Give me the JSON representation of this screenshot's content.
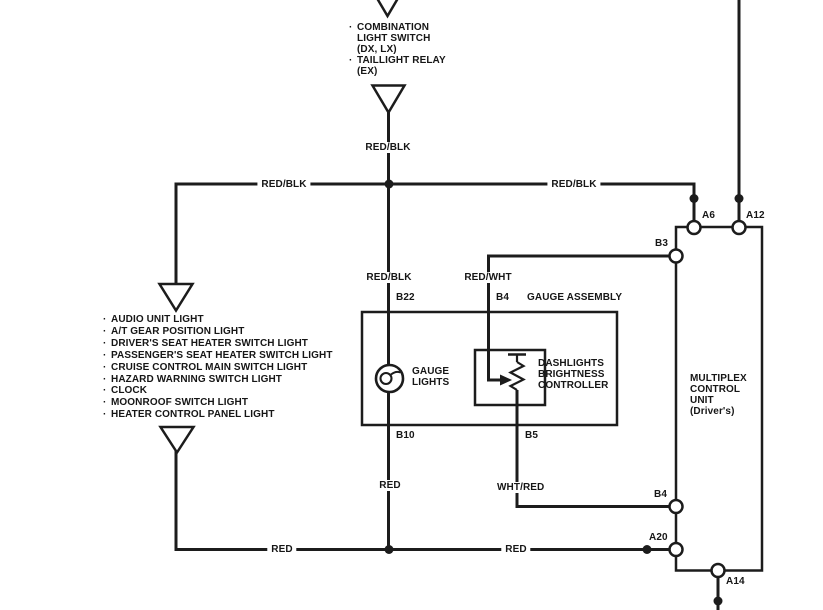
{
  "diagram": {
    "title_context": "dash lights circuit",
    "colors": {
      "line": "#1c1c1c",
      "background": "#ffffff"
    },
    "top_component_list": {
      "lines": [
        {
          "bullet": "·",
          "text": "COMBINATION"
        },
        {
          "bullet": "",
          "text": "LIGHT SWITCH"
        },
        {
          "bullet": "",
          "text": "(DX, LX)"
        },
        {
          "bullet": "·",
          "text": "TAILLIGHT RELAY"
        },
        {
          "bullet": "",
          "text": "(EX)"
        }
      ]
    },
    "left_component_list": {
      "lines": [
        {
          "bullet": "·",
          "text": "AUDIO UNIT LIGHT"
        },
        {
          "bullet": "·",
          "text": "A/T GEAR POSITION LIGHT"
        },
        {
          "bullet": "·",
          "text": "DRIVER'S SEAT HEATER SWITCH LIGHT"
        },
        {
          "bullet": "·",
          "text": "PASSENGER'S SEAT HEATER SWITCH LIGHT"
        },
        {
          "bullet": "·",
          "text": "CRUISE CONTROL MAIN SWITCH LIGHT"
        },
        {
          "bullet": "·",
          "text": "HAZARD WARNING SWITCH LIGHT"
        },
        {
          "bullet": "·",
          "text": "CLOCK"
        },
        {
          "bullet": "·",
          "text": "MOONROOF SWITCH LIGHT"
        },
        {
          "bullet": "·",
          "text": "HEATER CONTROL PANEL LIGHT"
        }
      ]
    },
    "wire_labels": {
      "red_blk_top": "RED/BLK",
      "red_blk_left": "RED/BLK",
      "red_blk_right": "RED/BLK",
      "red_blk_gauge": "RED/BLK",
      "red_wht": "RED/WHT",
      "red_gauge": "RED",
      "wht_red": "WHT/RED",
      "red_bottom_left": "RED",
      "red_bottom_right": "RED"
    },
    "terminals": {
      "b22": "B22",
      "b4_gauge": "B4",
      "b10": "B10",
      "b5": "B5",
      "b3": "B3",
      "a6": "A6",
      "a12": "A12",
      "b4_mux": "B4",
      "a20": "A20",
      "a14": "A14"
    },
    "components": {
      "gauge_assembly_title": "GAUGE ASSEMBLY",
      "gauge_lights": {
        "lines": [
          "GAUGE",
          "LIGHTS"
        ]
      },
      "dashlights_controller": {
        "lines": [
          "DASHLIGHTS",
          "BRIGHTNESS",
          "CONTROLLER"
        ]
      },
      "multiplex_unit": {
        "lines": [
          "MULTIPLEX",
          "CONTROL",
          "UNIT",
          "(Driver's)"
        ]
      }
    }
  }
}
